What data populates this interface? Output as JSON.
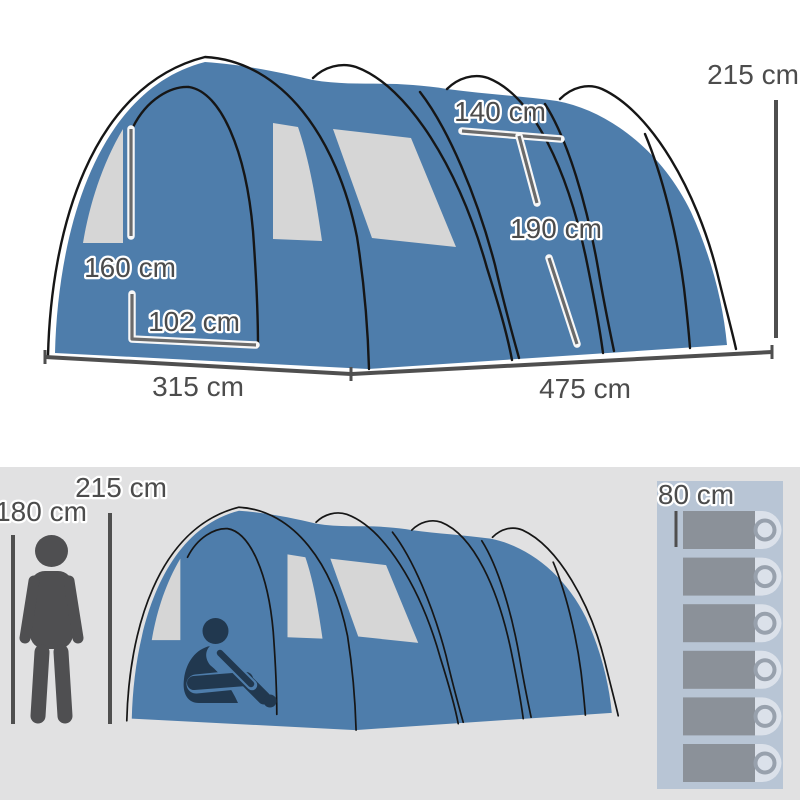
{
  "page": {
    "title": "Tunnel tent dimension diagram"
  },
  "top_diagram": {
    "tent_height": "215 cm",
    "door_width": "140 cm",
    "door_height": "190 cm",
    "window_height": "160 cm",
    "window_width": "102 cm",
    "front_width": "315 cm",
    "side_length": "475 cm"
  },
  "bottom_diagram": {
    "person_height": "180 cm",
    "tent_height": "215 cm",
    "sleeping_bag_width": "80 cm",
    "sleeping_bag_count": 6
  },
  "colors": {
    "tent-blue": "#4e7dab",
    "window-gray": "#d6d6d6",
    "outline-black": "#161616",
    "label-gray": "#4c4c4c",
    "line-dark": "#4f4f4f",
    "line-light": "#6b6b6b",
    "bg-bottom": "#e1e1e2",
    "figure-gray": "#4f4f51",
    "figure-navy": "#21384f",
    "panel-blue": "#b8c5d5",
    "bag-gray": "#8b9199",
    "pillow-light": "#dbe1ea",
    "ring-gray": "#98a1ad"
  }
}
